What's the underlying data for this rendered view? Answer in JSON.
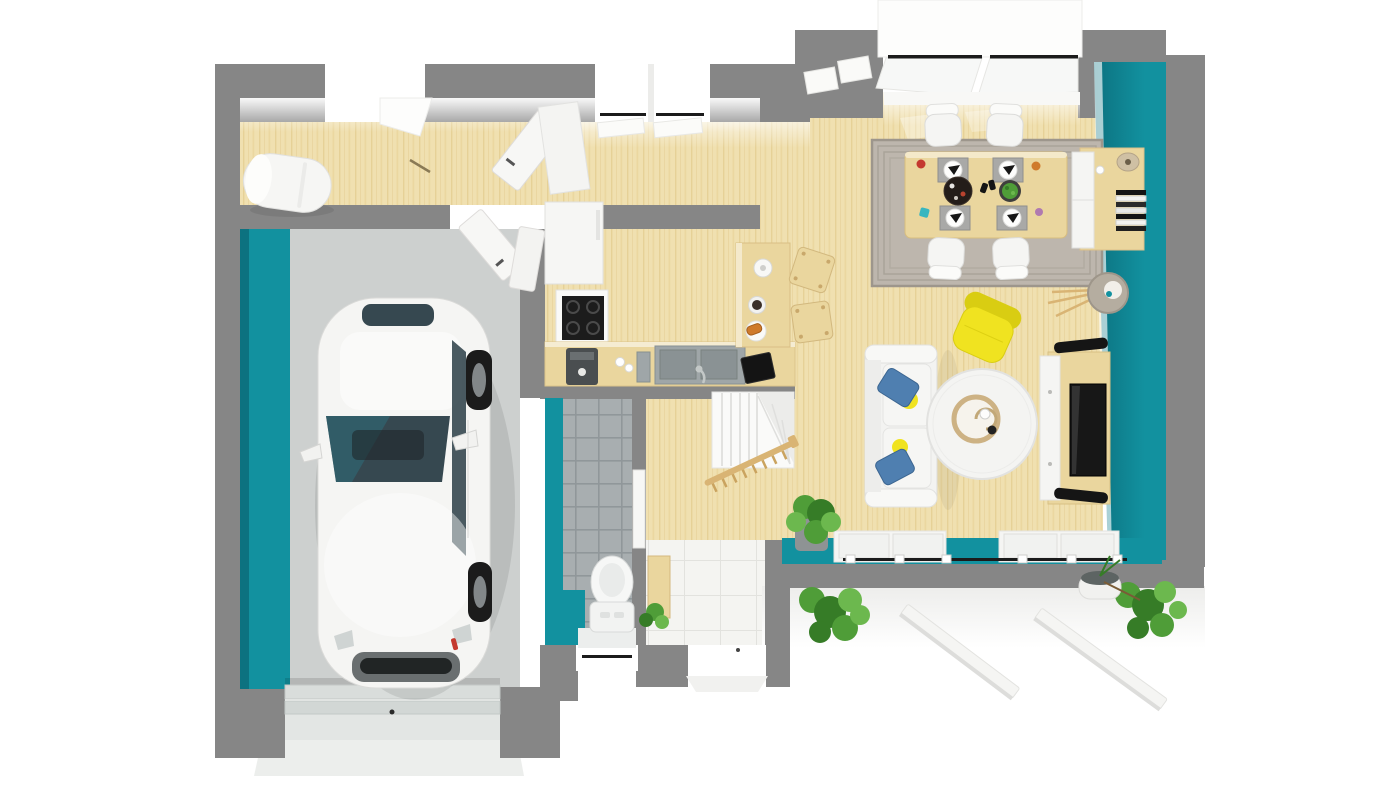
{
  "scene": {
    "kind": "3d-top-down-floor-plan-render",
    "description": "Top-down 3D rendering of a single-storey house: garage with white car, utility room with water heater, L-shaped kitchen with breakfast bar, open dining and living area with teal accent walls, WC, entry hall with staircase, terrace with planters",
    "width": 1400,
    "height": 788,
    "background": "#ffffff"
  },
  "palette": {
    "wall_gray": "#868686",
    "wall_gray_dark": "#6e6e6e",
    "teal": "#12919f",
    "teal_dark": "#0c7280",
    "wood": "#f0e0b0",
    "wood_grain": "#e2cb8e",
    "wood_mid": "#ead69e",
    "wood_dark": "#d8ba7a",
    "garage_floor": "#cdd0cf",
    "tile": "#a8aeb0",
    "grout": "#90979a",
    "entry_tile": "#f4f4f1",
    "off_white": "#f5f5f3",
    "black": "#1b1b1b",
    "dark_gray": "#4a4e50",
    "steel": "#9fa6a8",
    "glass": "#364850",
    "glass_teal": "#2e6e7a",
    "rug": "#bdb6ad",
    "rug_line": "#9d968c",
    "yellow": "#f0e320",
    "yellow_dark": "#d9cd12",
    "blue": "#4f7fb0",
    "green": "#4f9d38",
    "green_dark": "#367c27",
    "green_light": "#6cb84e",
    "tan": "#d9b474",
    "beige": "#cfc0a4",
    "red": "#c4392f",
    "orange": "#cf7a2b"
  },
  "rooms": [
    {
      "name": "garage"
    },
    {
      "name": "utility-room"
    },
    {
      "name": "kitchen"
    },
    {
      "name": "dining-area"
    },
    {
      "name": "living-room"
    },
    {
      "name": "wc"
    },
    {
      "name": "entry-hall"
    },
    {
      "name": "staircase"
    },
    {
      "name": "terrace"
    },
    {
      "name": "driveway"
    }
  ],
  "objects": [
    "white-car",
    "garage-door",
    "water-heater",
    "fridge",
    "tall-cabinet",
    "cooktop",
    "kitchen-counter",
    "kitchen-sink",
    "coffee-machine",
    "laptop",
    "breakfast-bar",
    "bar-stool",
    "dining-table",
    "dining-chair",
    "rug",
    "placemat",
    "salad-bowl",
    "serving-tray",
    "sideboard",
    "books",
    "vase",
    "floor-lamp",
    "yellow-armchair",
    "sofa",
    "blue-pillow",
    "yellow-pillow",
    "coffee-table",
    "tv-stand",
    "tv",
    "speaker",
    "toilet",
    "shoe-cabinet",
    "stairs",
    "railing",
    "plant",
    "planter",
    "bush",
    "sliding-door",
    "window",
    "front-door",
    "interior-door",
    "terrace-beam"
  ]
}
